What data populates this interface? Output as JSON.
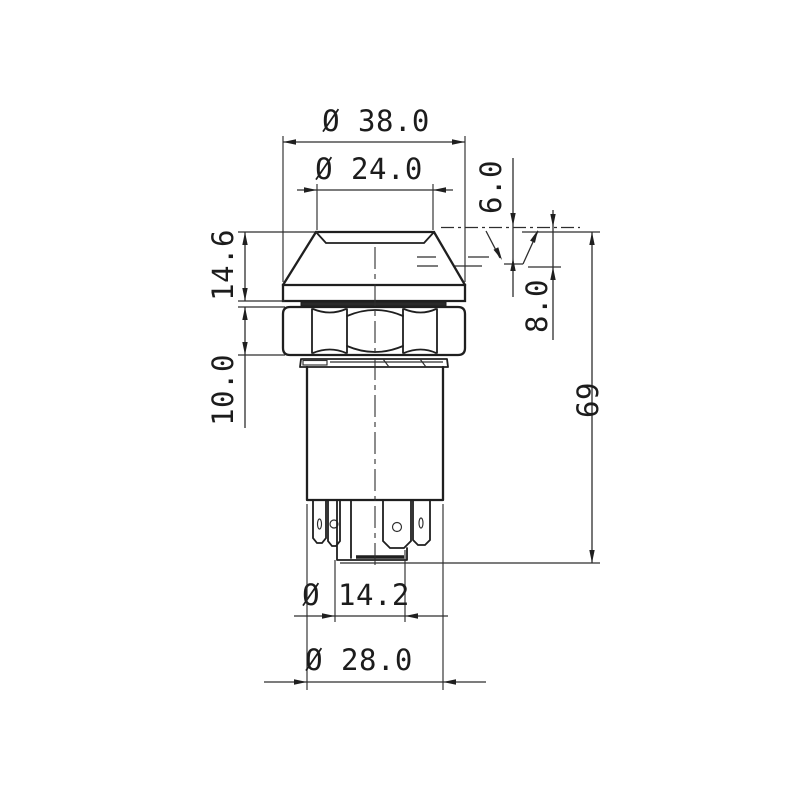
{
  "drawing": {
    "kind": "technical-dimension-drawing",
    "subject": "push-button switch side view",
    "colors": {
      "background": "#ffffff",
      "line": "#1f1f1f"
    },
    "dims": {
      "d38": "Ø 38.0",
      "d24": "Ø 24.0",
      "d6": "6.0",
      "d14_6": "14.6",
      "d8": "8.0",
      "d10": "10.0",
      "d69": "69",
      "d14_2": "Ø 14.2",
      "d28": "Ø 28.0"
    }
  }
}
